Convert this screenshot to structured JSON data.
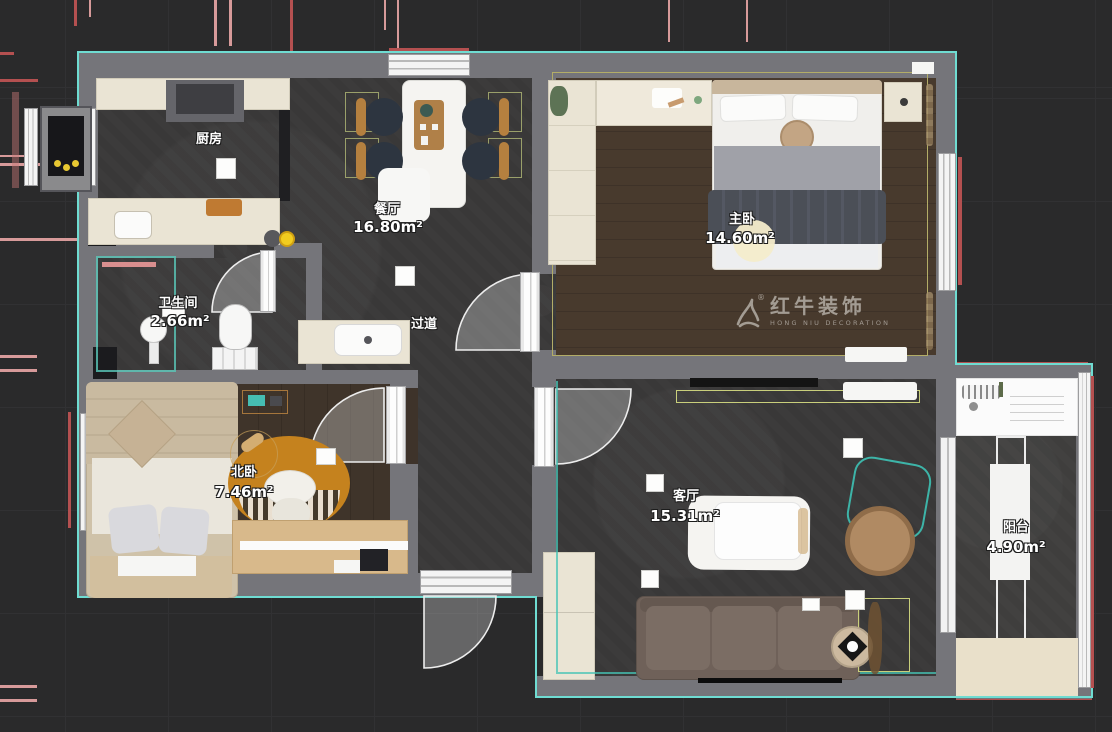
{
  "plan": {
    "watermark": {
      "brand": "红牛装饰",
      "sub": "HONG NIU DECORATION",
      "reg": "®"
    },
    "rooms": [
      {
        "name": "厨房",
        "area": ""
      },
      {
        "name": "餐厅",
        "area": "16.80m²"
      },
      {
        "name": "主卧",
        "area": "14.60m²"
      },
      {
        "name": "卫生间",
        "area": "2.66m²"
      },
      {
        "name": "过道",
        "area": ""
      },
      {
        "name": "北卧",
        "area": "7.46m²"
      },
      {
        "name": "客厅",
        "area": "15.31m²"
      },
      {
        "name": "阳台",
        "area": "4.90m²"
      }
    ],
    "colors": {
      "outline": "#6fdcd2",
      "wall": "#75757a",
      "floor_tile": "#3c3b3b",
      "floor_wood": "#47392d",
      "accent_teal": "#3fbfae",
      "accent_lime": "#c9cf7b",
      "annotation_red": "#b45050",
      "annotation_pink": "#d79a9a",
      "highlight_yellow": "#f2cc1f"
    }
  }
}
